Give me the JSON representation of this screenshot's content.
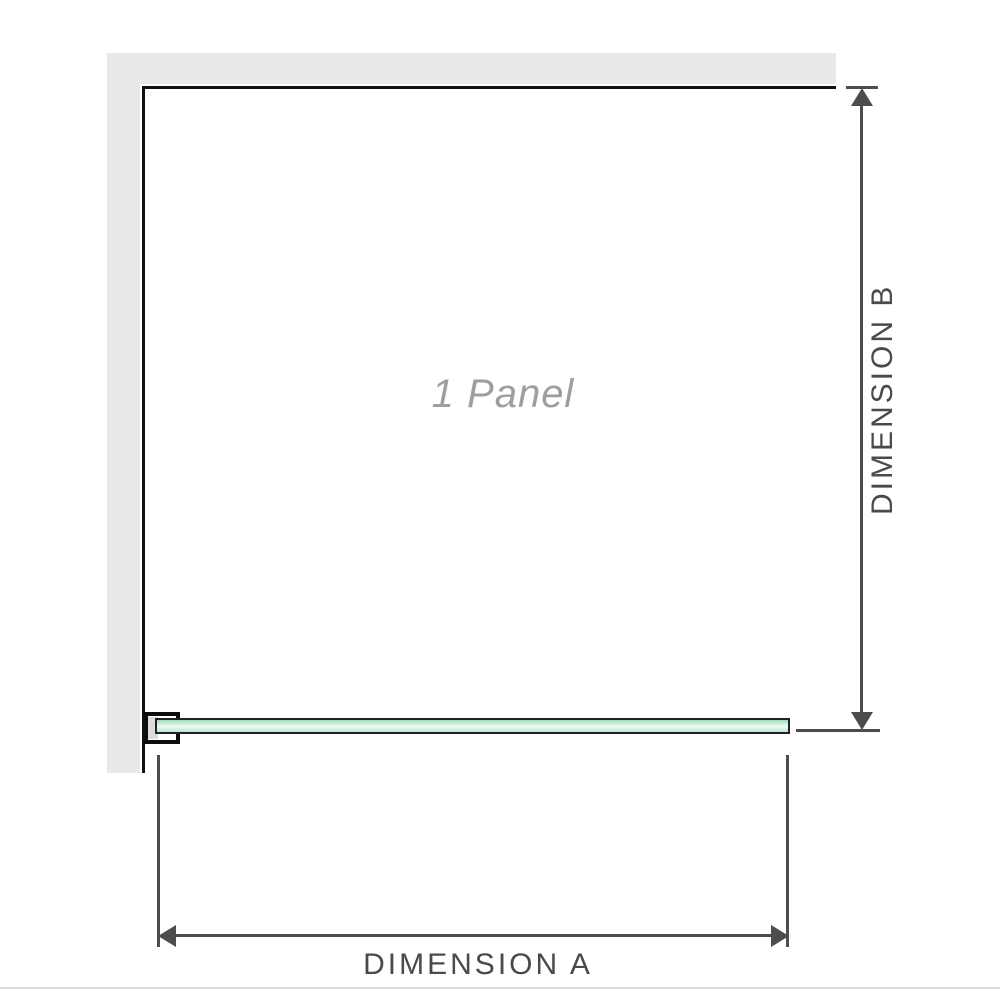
{
  "diagram": {
    "panel_label": "1 Panel",
    "dimensions": {
      "a_label": "DIMENSION A",
      "b_label": "DIMENSION B"
    }
  },
  "colors": {
    "wall": "#e9e9e9",
    "outline": "#101010",
    "dimension_lines": "#4d4d4d",
    "dimension_label_text": "#4a4a4a",
    "panel_label_text": "#9e9e9e",
    "glass_border": "#1e241f",
    "glass_green": "#c8ecd6",
    "glass_highlight": "#f2faf5",
    "bracket_outline": "#0d0d0d",
    "bracket_fill": "#dcdcdc",
    "bottom_border": "#dedbd3"
  }
}
